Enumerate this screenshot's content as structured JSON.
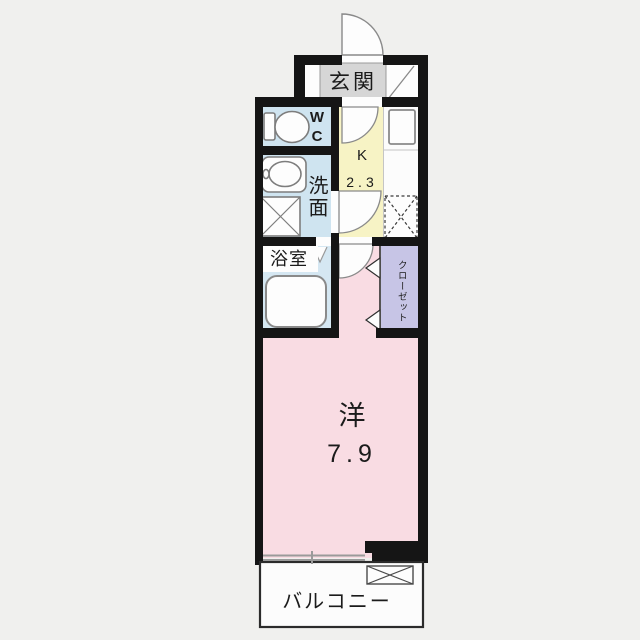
{
  "floorplan": {
    "title": "1K apartment floor plan",
    "rooms": {
      "genkan": {
        "label": "玄関"
      },
      "wc": {
        "label": "WC"
      },
      "washroom": {
        "label": "洗面"
      },
      "kitchen": {
        "label": "K",
        "size": "2.3"
      },
      "bath": {
        "label": "浴室"
      },
      "closet": {
        "label": "クローゼット"
      },
      "western_room": {
        "label": "洋",
        "size": "7.9"
      },
      "balcony": {
        "label": "バルコニー"
      }
    },
    "colors": {
      "background": "#f0f0ee",
      "wall": "#151515",
      "wet_area_blue": "#cfe4f0",
      "kitchen_yellow": "#f7f3c5",
      "room_pink": "#f9dce3",
      "closet_lavender": "#c7c5e6",
      "genkan_gray": "#d6d6d6",
      "fixture_stroke": "#7d7d7d"
    }
  }
}
